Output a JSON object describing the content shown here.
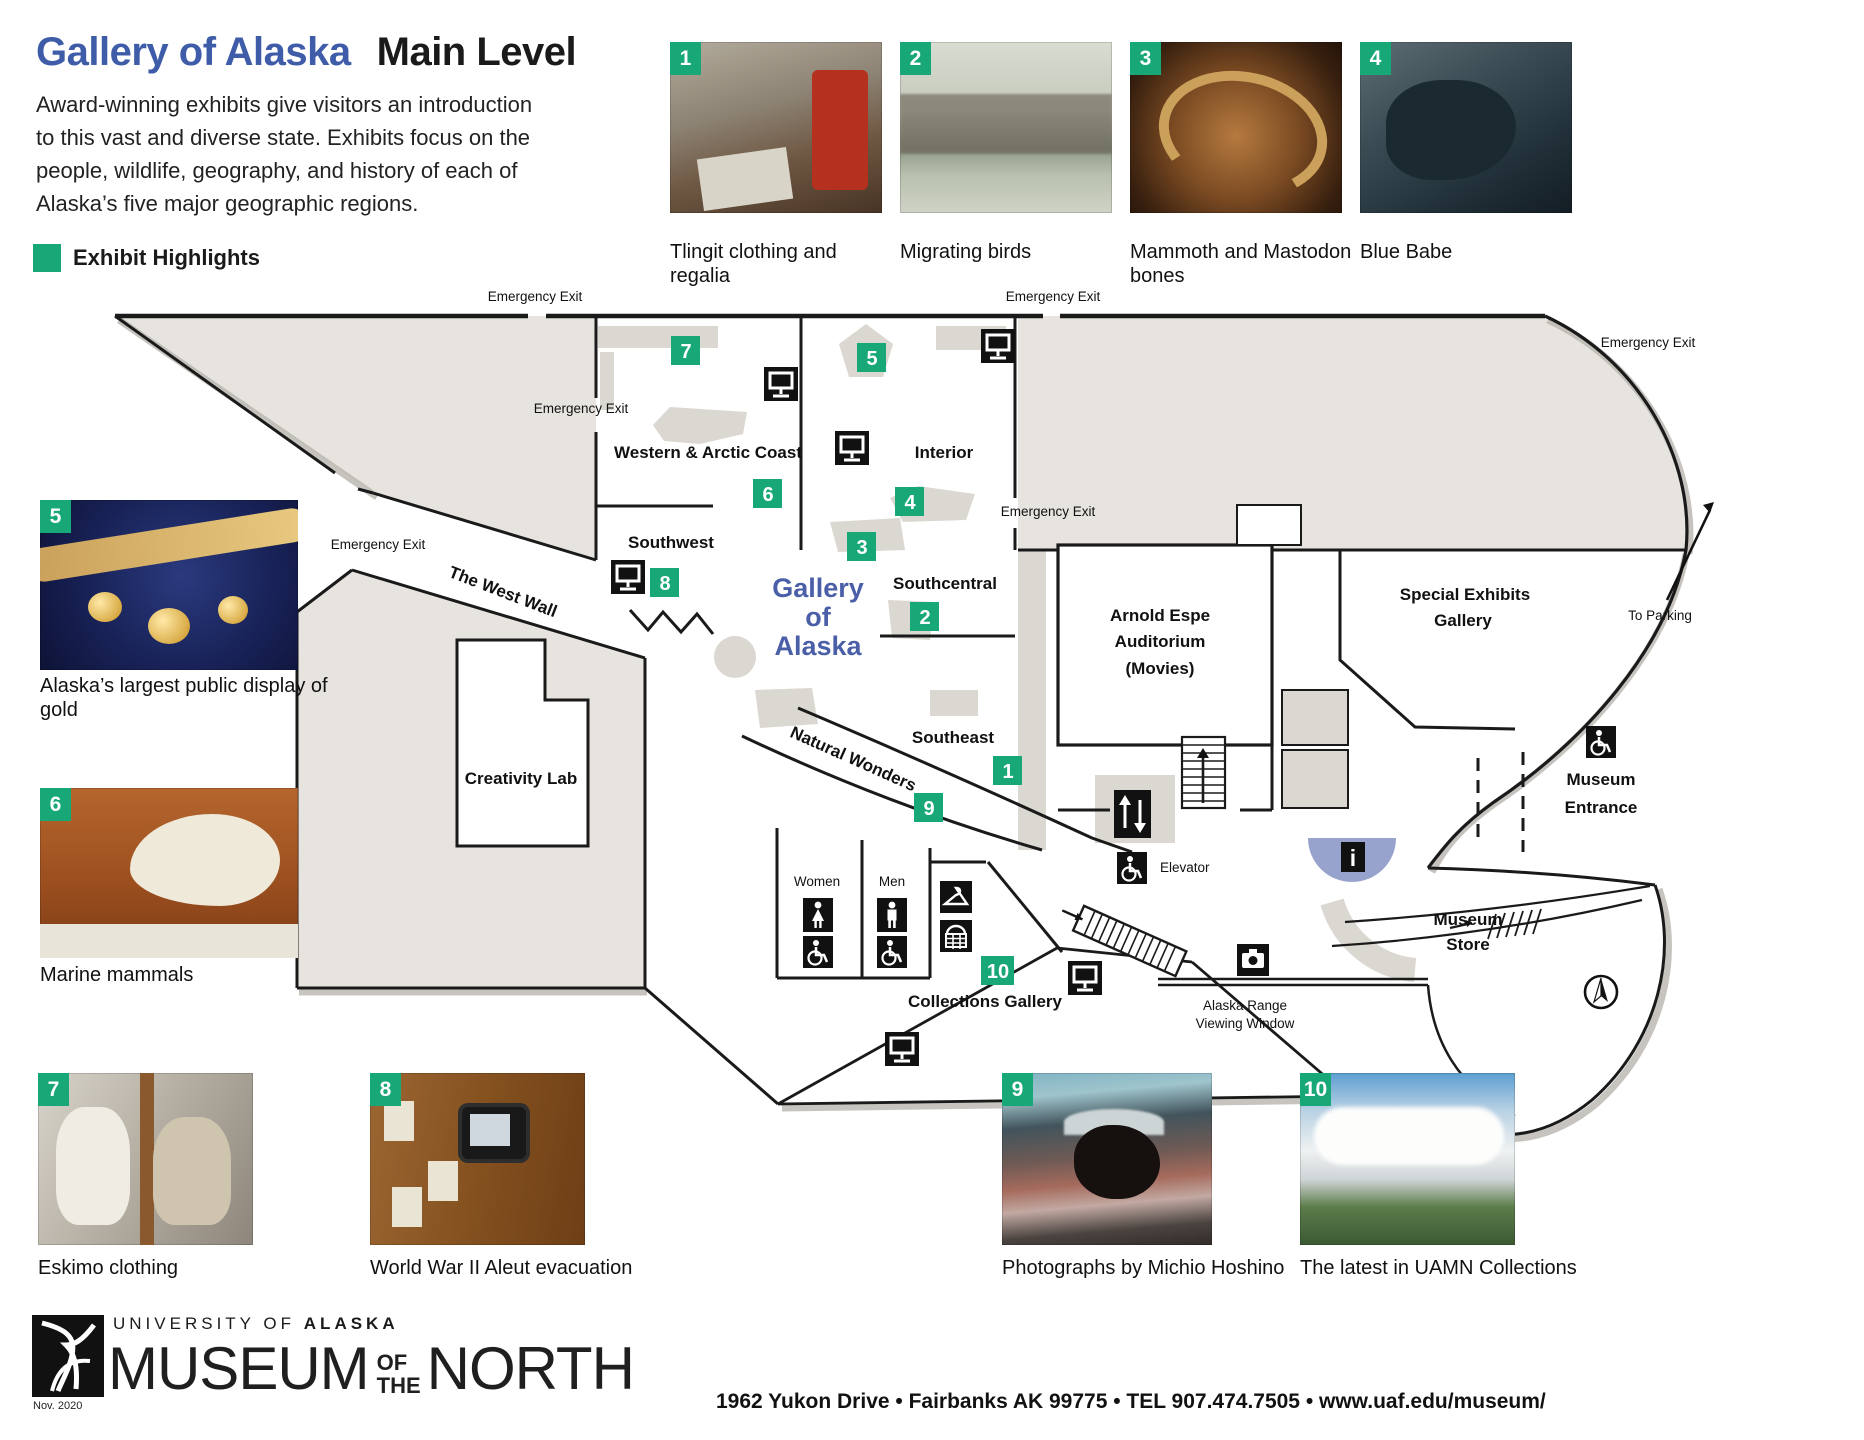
{
  "header": {
    "title_blue": "Gallery of Alaska",
    "title_black": "Main Level",
    "paragraph_lines": [
      "Award-winning exhibits give visitors an introduction",
      "to this vast and diverse state. Exhibits focus on the",
      "people, wildlife, geography, and history of each of",
      "Alaska’s five major geographic regions."
    ],
    "legend": "Exhibit Highlights"
  },
  "colors": {
    "accent_green": "#18A878",
    "accent_blue": "#3E5CA8",
    "map_gray": "#E7E4E0",
    "fixture_gray": "#DBD7D1",
    "info_blue": "#98A3CD"
  },
  "top_exhibits": [
    {
      "num": "1",
      "caption": "Tlingit clothing and regalia"
    },
    {
      "num": "2",
      "caption": "Migrating birds"
    },
    {
      "num": "3",
      "caption": "Mammoth and Mastodon bones"
    },
    {
      "num": "4",
      "caption": "Blue Babe"
    }
  ],
  "side_exhibits": [
    {
      "num": "5",
      "caption": "Alaska’s largest public display of gold"
    },
    {
      "num": "6",
      "caption": "Marine mammals"
    }
  ],
  "bottom_exhibits": [
    {
      "num": "7",
      "caption": "Eskimo clothing"
    },
    {
      "num": "8",
      "caption": "World War II Aleut evacuation"
    },
    {
      "num": "9",
      "caption": "Photographs by Michio Hoshino"
    },
    {
      "num": "10",
      "caption": "The latest in UAMN Collections"
    }
  ],
  "map": {
    "marker_numbers": [
      "1",
      "2",
      "3",
      "4",
      "5",
      "6",
      "7",
      "8",
      "9",
      "10"
    ],
    "labels": {
      "emergency_exit": "Emergency Exit",
      "western_arctic": "Western & Arctic Coast",
      "interior": "Interior",
      "southwest": "Southwest",
      "southcentral": "Southcentral",
      "southeast": "Southeast",
      "west_wall": "The West Wall",
      "natural_wonders": "Natural Wonders",
      "creativity_lab": "Creativity Lab",
      "gallery_line1": "Gallery",
      "gallery_line2": "of",
      "gallery_line3": "Alaska",
      "auditorium_line1": "Arnold Espe",
      "auditorium_line2": "Auditorium",
      "auditorium_line3": "(Movies)",
      "special_line1": "Special Exhibits",
      "special_line2": "Gallery",
      "to_parking": "To Parking",
      "entrance_line1": "Museum",
      "entrance_line2": "Entrance",
      "store_line1": "Museum",
      "store_line2": "Store",
      "collections": "Collections Gallery",
      "elevator": "Elevator",
      "women": "Women",
      "men": "Men",
      "range_line1": "Alaska Range",
      "range_line2": "Viewing Window"
    },
    "icons": [
      "video-monitor-icon",
      "elevator-arrows-icon",
      "wheelchair-icon",
      "restroom-female-icon",
      "restroom-male-icon",
      "coat-hanger-icon",
      "locker-icon",
      "camera-icon",
      "information-icon",
      "north-compass-icon",
      "stairs-icon",
      "escalator-icon"
    ]
  },
  "footer": {
    "university_prefix": "UNIVERSITY OF",
    "university_bold": "ALASKA",
    "museum_word": "MUSEUM",
    "of_word": "OF",
    "the_word": "THE",
    "north_word": "NORTH",
    "date": "Nov. 2020",
    "address": "1962 Yukon Drive • Fairbanks AK 99775 • TEL 907.474.7505 • www.uaf.edu/museum/"
  }
}
